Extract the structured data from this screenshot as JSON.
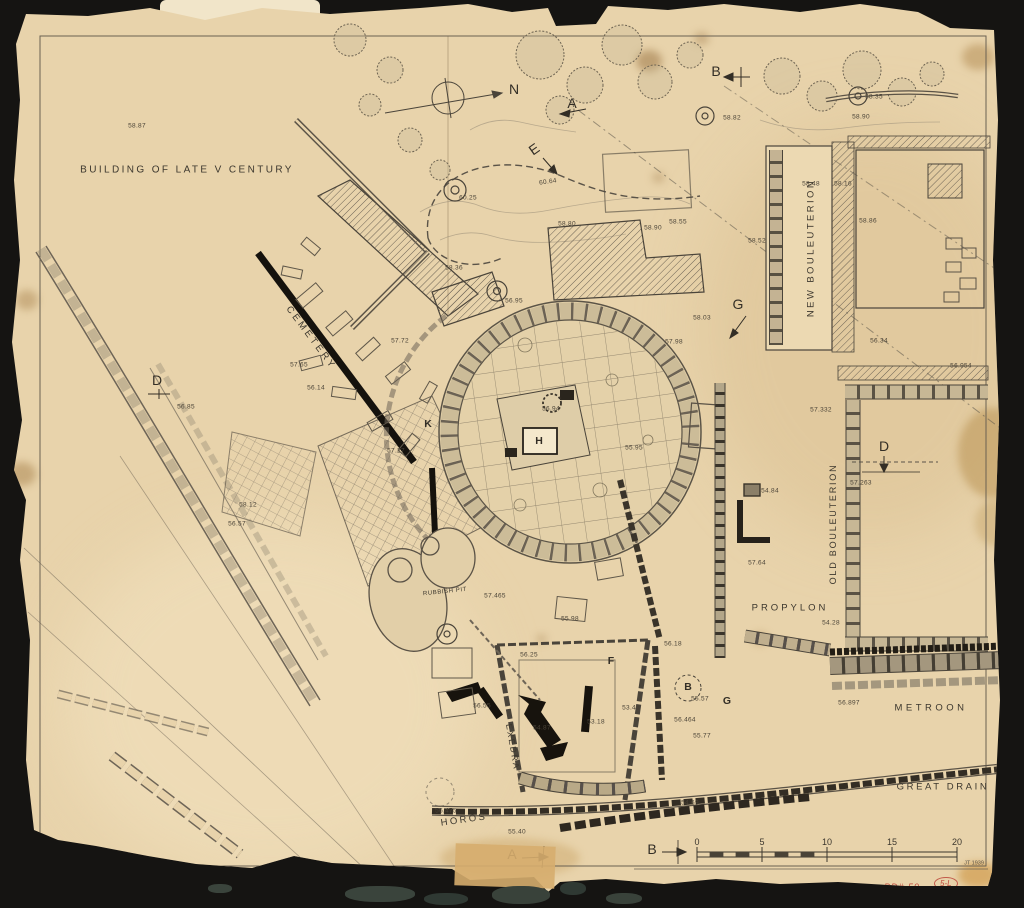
{
  "colors": {
    "background": "#151412",
    "paper": "#e8d3ab",
    "ink": "#453f35",
    "black_ink": "#17130d",
    "red_annotation": "#bf4a3c"
  },
  "plan": {
    "compass": {
      "north_label": "N"
    },
    "area_labels": [
      {
        "name": "label-building-of-late-v-century",
        "text": "BUILDING OF LATE V CENTURY",
        "x": 187,
        "y": 170,
        "rot": 0,
        "size": 10,
        "ls": 2.4
      },
      {
        "name": "label-cemetery",
        "text": "CEMETERY",
        "x": 311,
        "y": 338,
        "rot": 53,
        "size": 9.5,
        "ls": 3
      },
      {
        "name": "label-new-bouleuterion",
        "text": "NEW BOULEUTERION",
        "x": 811,
        "y": 248,
        "rot": -90,
        "size": 9.5,
        "ls": 2.4
      },
      {
        "name": "label-old-bouleuterion",
        "text": "OLD BOULEUTERION",
        "x": 833,
        "y": 524,
        "rot": -90,
        "size": 9,
        "ls": 1.8
      },
      {
        "name": "label-propylon",
        "text": "PROPYLON",
        "x": 790,
        "y": 608,
        "rot": 0,
        "size": 9.5,
        "ls": 3
      },
      {
        "name": "label-metroon",
        "text": "METROON",
        "x": 931,
        "y": 708,
        "rot": 0,
        "size": 9.5,
        "ls": 3.5
      },
      {
        "name": "label-great-drain",
        "text": "GREAT DRAIN",
        "x": 943,
        "y": 787,
        "rot": 0,
        "size": 9.5,
        "ls": 2.6
      },
      {
        "name": "label-rubbish-pit",
        "text": "RUBBISH PIT",
        "x": 445,
        "y": 592,
        "rot": -6,
        "size": 6,
        "ls": 0.6
      },
      {
        "name": "label-exedra",
        "text": "EXEDRA",
        "x": 513,
        "y": 747,
        "rot": 80,
        "size": 8.5,
        "ls": 2
      },
      {
        "name": "label-horos",
        "text": "HOROS",
        "x": 464,
        "y": 820,
        "rot": -8,
        "size": 9.5,
        "ls": 2.4
      }
    ],
    "section_markers": [
      {
        "label": "N",
        "x": 514,
        "y": 89
      },
      {
        "label": "A",
        "x": 572,
        "y": 103
      },
      {
        "label": "B",
        "x": 716,
        "y": 71
      },
      {
        "label": "E",
        "x": 534,
        "y": 149,
        "rot": -35
      },
      {
        "label": "G",
        "x": 738,
        "y": 304
      },
      {
        "label": "D",
        "x": 157,
        "y": 380
      },
      {
        "label": "D",
        "x": 884,
        "y": 446
      },
      {
        "label": "A",
        "x": 512,
        "y": 854
      },
      {
        "label": "B",
        "x": 652,
        "y": 849
      }
    ],
    "reference_letters": [
      {
        "label": "H",
        "x": 539,
        "y": 441
      },
      {
        "label": "K",
        "x": 428,
        "y": 424
      },
      {
        "label": "F",
        "x": 611,
        "y": 661
      },
      {
        "label": "B",
        "x": 688,
        "y": 687
      },
      {
        "label": "G",
        "x": 727,
        "y": 701
      }
    ],
    "spot_elevations": [
      {
        "v": "58.87",
        "x": 137,
        "y": 126
      },
      {
        "v": "58.35",
        "x": 874,
        "y": 97
      },
      {
        "v": "58.90",
        "x": 861,
        "y": 117
      },
      {
        "v": "58.82",
        "x": 732,
        "y": 118
      },
      {
        "v": "58.48",
        "x": 811,
        "y": 184
      },
      {
        "v": "58.16",
        "x": 843,
        "y": 184
      },
      {
        "v": "58.52",
        "x": 757,
        "y": 241
      },
      {
        "v": "58.86",
        "x": 868,
        "y": 221
      },
      {
        "v": "56.34",
        "x": 879,
        "y": 341
      },
      {
        "v": "56.954",
        "x": 961,
        "y": 366
      },
      {
        "v": "57.332",
        "x": 821,
        "y": 410
      },
      {
        "v": "57.263",
        "x": 861,
        "y": 483
      },
      {
        "v": "54.84",
        "x": 770,
        "y": 491
      },
      {
        "v": "57.64",
        "x": 757,
        "y": 563
      },
      {
        "v": "54.28",
        "x": 831,
        "y": 623
      },
      {
        "v": "56.897",
        "x": 849,
        "y": 703
      },
      {
        "v": "60.25",
        "x": 468,
        "y": 198
      },
      {
        "v": "60.64",
        "x": 548,
        "y": 182,
        "rot": -8
      },
      {
        "v": "58.80",
        "x": 567,
        "y": 224
      },
      {
        "v": "58.36",
        "x": 454,
        "y": 268
      },
      {
        "v": "58.55",
        "x": 678,
        "y": 222
      },
      {
        "v": "58.90",
        "x": 653,
        "y": 228
      },
      {
        "v": "58.03",
        "x": 702,
        "y": 318
      },
      {
        "v": "57.72",
        "x": 400,
        "y": 341
      },
      {
        "v": "57.65",
        "x": 299,
        "y": 365
      },
      {
        "v": "56.14",
        "x": 316,
        "y": 388
      },
      {
        "v": "56.85",
        "x": 186,
        "y": 407
      },
      {
        "v": "58.12",
        "x": 248,
        "y": 505
      },
      {
        "v": "56.57",
        "x": 237,
        "y": 524
      },
      {
        "v": "56.95",
        "x": 514,
        "y": 301
      },
      {
        "v": "56.94",
        "x": 551,
        "y": 409
      },
      {
        "v": "57.27",
        "x": 396,
        "y": 451
      },
      {
        "v": "57.98",
        "x": 674,
        "y": 342
      },
      {
        "v": "55.95",
        "x": 634,
        "y": 448
      },
      {
        "v": "57.465",
        "x": 495,
        "y": 596
      },
      {
        "v": "55.98",
        "x": 570,
        "y": 619
      },
      {
        "v": "56.25",
        "x": 529,
        "y": 655
      },
      {
        "v": "56.18",
        "x": 673,
        "y": 644
      },
      {
        "v": "55.57",
        "x": 700,
        "y": 699
      },
      {
        "v": "53.45",
        "x": 631,
        "y": 708
      },
      {
        "v": "53.18",
        "x": 596,
        "y": 722
      },
      {
        "v": "56.464",
        "x": 685,
        "y": 720
      },
      {
        "v": "55.77",
        "x": 702,
        "y": 736
      },
      {
        "v": "56.55",
        "x": 482,
        "y": 706
      },
      {
        "v": "54.87",
        "x": 542,
        "y": 728
      },
      {
        "v": "56.475",
        "x": 446,
        "y": 811
      },
      {
        "v": "55.40",
        "x": 517,
        "y": 832
      },
      {
        "v": "54.69",
        "x": 690,
        "y": 803
      }
    ],
    "scale_bar": {
      "tick_labels": [
        "0",
        "5",
        "10",
        "15",
        "20"
      ],
      "tick_x": [
        697,
        762,
        827,
        892,
        957
      ],
      "y": 842,
      "note": "JT 1939",
      "note_x": 974,
      "note_y": 864
    },
    "annotations": {
      "catalog_number": "A 4334",
      "drawing_number": "PD# 59",
      "red_circled_mark": "5-L"
    }
  }
}
